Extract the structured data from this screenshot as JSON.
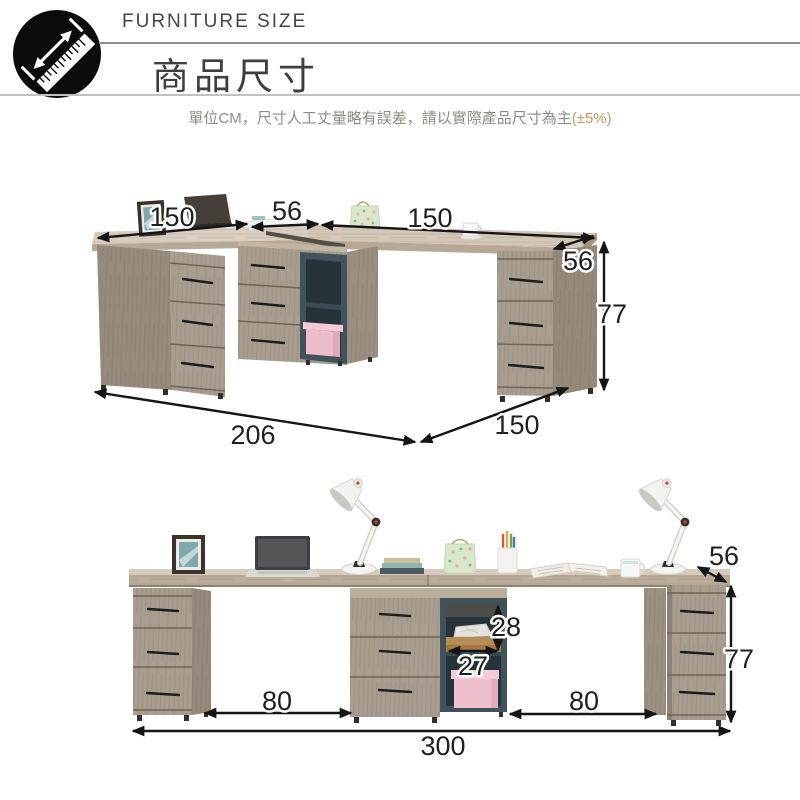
{
  "header": {
    "brand_label": "FURNITURE SIZE",
    "title": "商品尺寸",
    "subtitle": "單位CM，尺寸人工丈量略有誤差，請以實際產品尺寸為主",
    "tolerance_note": "(±5%)",
    "icon": "ruler-measure-icon"
  },
  "colors": {
    "tolerance_note": "#c2995f",
    "subtitle_text": "#8b8b83",
    "heading_text": "#3e3e3e",
    "divider_dark": "#8f8f8f",
    "divider_light": "#c0c0c0",
    "arrow": "#151515",
    "desk_top": "#d5c9b9",
    "desk_edge": "#b7a896",
    "cabinet_front": "#a89d8e",
    "cabinet_side": "#968b7c",
    "shelf_frame": "#41535a",
    "shelf_interior": "#263339",
    "shelf_board": "#b68e55",
    "pink_box": "#eec0cc",
    "lamp_body": "#f3f3f0",
    "gift_bag_green": "#d9e7cb"
  },
  "top_diagram": {
    "dims": {
      "left_width": "150",
      "corner_width": "56",
      "right_width": "150",
      "right_depth": "56",
      "height": "77",
      "left_total_length": "206",
      "bottom_depth": "150"
    }
  },
  "bottom_diagram": {
    "dims": {
      "depth": "56",
      "shelf_inner_height": "28",
      "shelf_inner_width": "27",
      "height": "77",
      "left_clearance": "80",
      "right_clearance": "80",
      "total_width": "300"
    }
  }
}
